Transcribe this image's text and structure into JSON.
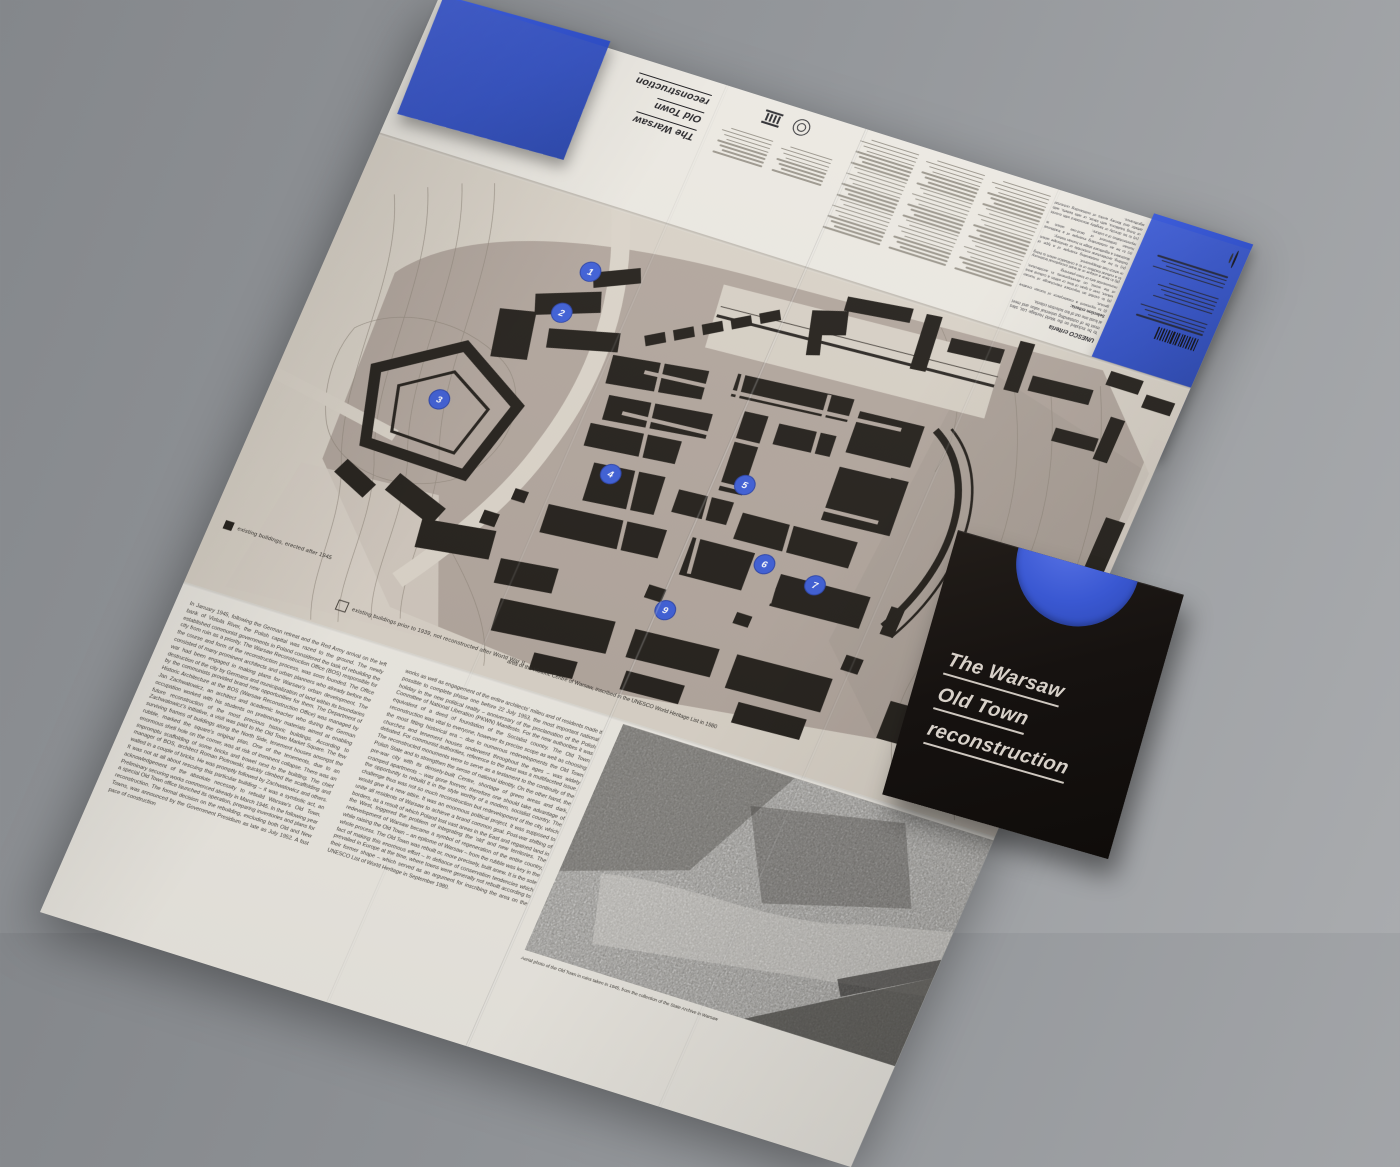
{
  "publication": {
    "sleeve": {
      "title_lines": [
        "The Warsaw",
        "Old Town",
        "reconstruction"
      ]
    },
    "back_cover": {
      "title_lines": [
        "The Warsaw",
        "Old Town",
        "reconstruction"
      ],
      "unesco_criteria": {
        "heading": "UNESCO criteria",
        "intro": "To be included on the World Heritage List, sites must be of outstanding universal value and meet at least one out of ten selection criteria.",
        "selection_label": "Selection criteria:",
        "items": [
          "(i) to represent a masterpiece of human creative genius;",
          "(ii) to exhibit an important interchange of human values, over a span of time or within a cultural area of the world, on developments in architecture, monumental arts or town-planning;",
          "(iii) to bear a unique or at least exceptional testimony to a cultural tradition or to a civilisation which is living or which has disappeared;",
          "(iv) to be an outstanding example of a type of building, architectural ensemble or landscape which illustrates a significant stage in human history;",
          "(v) to be an outstanding example of a traditional human settlement or land-use which is representative of a culture;",
          "(vi) to be directly or tangibly associated with events or living traditions, with ideas, or with beliefs, with artistic and literary works of outstanding universal significance."
        ]
      },
      "has_barcode": true,
      "logo_icons": [
        "copyright-ring",
        "unesco-emblem"
      ]
    },
    "map": {
      "legend": [
        {
          "symbol": "filled-square",
          "label": "existing buildings, erected after 1945"
        },
        {
          "symbol": "outline-square",
          "label": "existing buildings prior to 1939, not reconstructed after World War II"
        }
      ],
      "area_caption": "area of the Historic Centre of Warsaw, inscribed in the UNESCO World Heritage List in 1980",
      "markers": [
        {
          "n": "1",
          "x": 250,
          "y": 70
        },
        {
          "n": "2",
          "x": 240,
          "y": 118
        },
        {
          "n": "3",
          "x": 162,
          "y": 238
        },
        {
          "n": "4",
          "x": 350,
          "y": 258
        },
        {
          "n": "5",
          "x": 478,
          "y": 228
        },
        {
          "n": "6",
          "x": 528,
          "y": 298
        },
        {
          "n": "7",
          "x": 583,
          "y": 303
        },
        {
          "n": "8",
          "x": 732,
          "y": 262
        },
        {
          "n": "9",
          "x": 455,
          "y": 372
        }
      ]
    },
    "articles": {
      "left": "In January 1945, following the German retreat and the Red Army arrival on the left bank of Vistula River, the Polish capital was razed to the ground. The newly established communist governments in Poland considered the task of rebuilding the city from ruin as a priority. The Warsaw Reconstruction Office (BOS) responsible for the course and form of the reconstruction process, was soon founded. The Office consisted of many prominent architects and urban planners who already before the war had been engaged in making plans for Warsaw's urban development. The destruction of the city by Germans and municipalization of land within its boundaries by the communists provided brand new opportunities for them. The Department of Historic Architecture at the BOS (Warsaw Reconstruction Office) was managed by Jan Zachwatowicz, an architect and academic teacher who during the German occupation worked with his students on preliminary materials aimed at enabling future reconstruction of the most precious historic buildings. According to Zachwatowicz's initiative, a visit was paid to the Old Town Market Square. The few surviving frames of buildings along the North Side, tenement houses amongst the rubble, marked the square's original plan. One of the tenements, due to an enormous shell hole on the corner, was at risk of imminent collapse. There was an impromptu scaffolding of some bricks and trowel next to the building. The chief manager of BOS, architect Roman Piotrowski, quickly climbed the scaffolding and walled in a couple of bricks. He was promptly followed by Zachwatowicz and others. It was not at all about rescuing this particular building – it was a symbolic act, an acknowledgement of the absolute necessity to rebuild Warsaw's Old Town. Preliminary securing works commenced already in March 1945. In the following year a special Old Town office launched its operation, preparing inventories and plans for reconstruction. The formal decision on the rebuilding, excluding both Old and New Towns, was announced by the Government Presidium as late as July 1952. A fast pace of construction",
      "middle": "works as well as engagement of the entire architects' milieu and of residents made it possible to complete phase one before 22 July 1953, the most important national holiday in the new political reality – anniversary of the proclamation of the Polish Committee of National Liberation (PKWN) Manifesto. For the new authorities it was equivalent of a deed of foundation of the Socialist country. The Old Town reconstruction was vital to everyone, however its precise scope as well as choosing the most fitting historical era – due to numerous redevelopments the Old Town churches and tenement houses underwent throughout the ages – was widely debated. For communist authorities, reference to the past was a multifaceted issue. The reconstructed monuments were to serve as a testament to the continuity of the Polish State and to strengthen the sense of national identity. On the other hand, the pre-war city with its densely-built Centre, shortage of green areas and dark, cramped apartments – was gone forever, therefore one should take advantage of the opportunity to rebuild it in the style worthy of a modern, socialist country. The challenge thus was not so much reconstruction but redevelopment of the city, which would give it a new attire. It was an enormous political project. It was supposed to unite all residents of Warsaw to achieve a brand common goal. Post-war shifting of borders, as a result of which Poland lost vast areas in the East and regained land in the West, triggered the problem of integrating the 'old' and new territories. The redevelopment of Warsaw became a symbol of regeneration of the entire country, while raising the Old Town – an epitome of Warsaw – from the rubble was key in the whole process. The Old Town was rebuilt or, more precisely, built anew. It is the sole fact of making this enormous effort – in defiance of conservation tendencies which prevailed in Europe at the time, where towns were generally not rebuilt according to their former shape – which served as an argument for inscribing the area on the UNESCO List of World Heritage in September 1980."
    },
    "aerial_photo_caption": "Aerial photo of the Old Town in ruins taken in 1945, from the collection of the State Archive in Warsaw"
  },
  "colors": {
    "background_gray": "#93969a",
    "paper_cream": "#e9e6df",
    "map_light": "#d9d2c7",
    "map_taupe": "#b2a69d",
    "building_black": "#24201b",
    "accent_blue": "#2f4ec4",
    "marker_blue": "#3d5ed6",
    "sleeve_black": "#161210",
    "sleeve_title_silver": "#d8d1c9"
  }
}
